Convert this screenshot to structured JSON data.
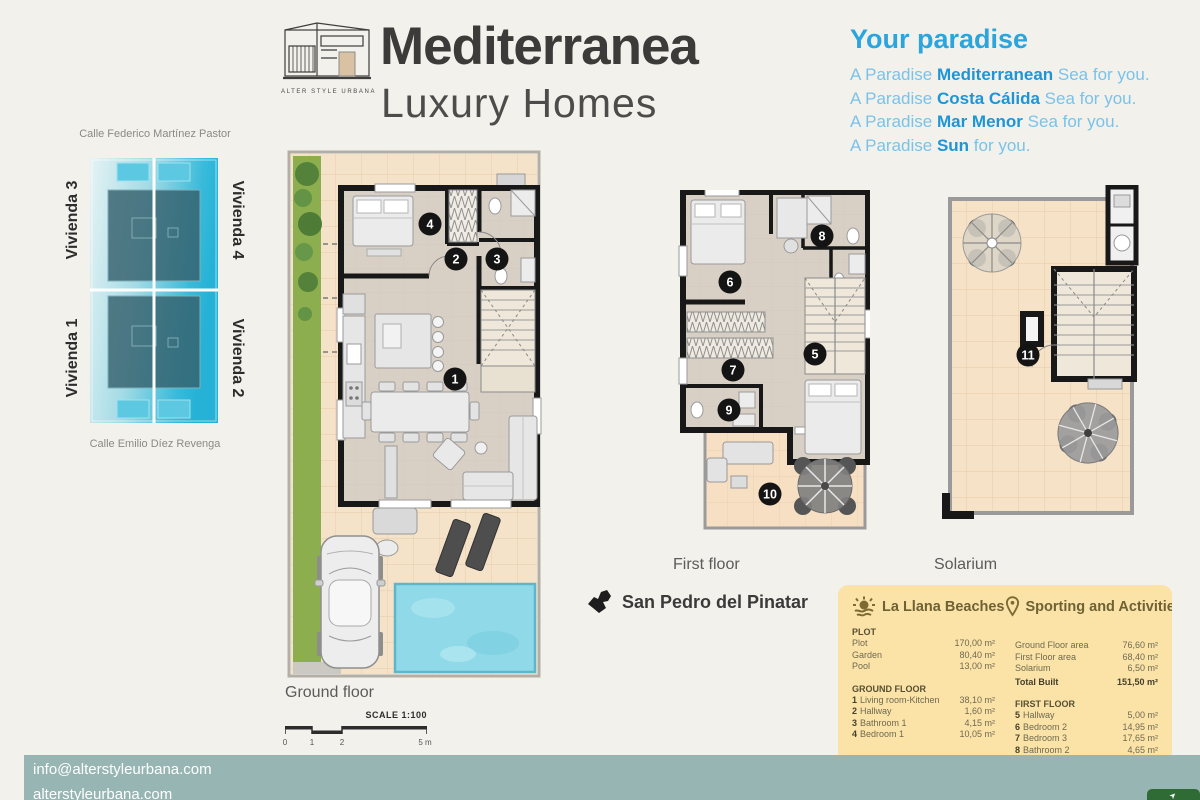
{
  "brand": {
    "caption": "ALTER STYLE URBANA",
    "title": "Mediterranea",
    "subtitle": "Luxury Homes"
  },
  "paradise": {
    "title": "Your paradise",
    "lines": [
      {
        "pre": "A Paradise ",
        "em": "Mediterranean",
        "post": " Sea for you."
      },
      {
        "pre": "A Paradise ",
        "em": "Costa Cálida",
        "post": " Sea for you."
      },
      {
        "pre": "A Paradise ",
        "em": "Mar Menor",
        "post": " Sea for you."
      },
      {
        "pre": "A Paradise ",
        "em": "Sun",
        "post": " for you."
      }
    ]
  },
  "site": {
    "street_top": "Calle Federico Martínez Pastor",
    "street_bottom": "Calle Emilio Díez Revenga",
    "unit_tl": "Vivienda 3",
    "unit_tr": "Vivienda 4",
    "unit_bl": "Vivienda 1",
    "unit_br": "Vivienda 2"
  },
  "plans": {
    "ground_label": "Ground floor",
    "first_label": "First floor",
    "solarium_label": "Solarium",
    "scale_label": "SCALE 1:100",
    "scale_ticks": [
      "0",
      "1",
      "2",
      "5 m"
    ],
    "markers": {
      "m1": "1",
      "m2": "2",
      "m3": "3",
      "m4": "4",
      "m5": "5",
      "m6": "6",
      "m7": "7",
      "m8": "8",
      "m9": "9",
      "m10": "10",
      "m11": "11"
    }
  },
  "location": {
    "name": "San Pedro del Pinatar"
  },
  "panel": {
    "beaches_title": "La Llana Beaches",
    "sports_title": "Sporting and Activities",
    "plot": {
      "title": "PLOT",
      "rows": [
        {
          "l": "Plot",
          "v": "170,00 m²"
        },
        {
          "l": "Garden",
          "v": "80,40 m²"
        },
        {
          "l": "Pool",
          "v": "13,00 m²"
        }
      ]
    },
    "built": {
      "rows": [
        {
          "l": "Ground Floor area",
          "v": "76,60 m²"
        },
        {
          "l": "First Floor area",
          "v": "68,40 m²"
        },
        {
          "l": "Solarium",
          "v": "6,50 m²"
        }
      ],
      "total_l": "Total Built",
      "total_v": "151,50 m²"
    },
    "ground": {
      "title": "GROUND FLOOR",
      "rows": [
        {
          "n": "1",
          "l": "Living room-Kitchen",
          "v": "38,10 m²"
        },
        {
          "n": "2",
          "l": "Hallway",
          "v": "1,60 m²"
        },
        {
          "n": "3",
          "l": "Bathroom 1",
          "v": "4,15 m²"
        },
        {
          "n": "4",
          "l": "Bedroom 1",
          "v": "10,05 m²"
        }
      ],
      "total_l": "Total floor area",
      "total_v": "76,60 m²"
    },
    "first": {
      "title": "FIRST FLOOR",
      "rows": [
        {
          "n": "5",
          "l": "Hallway",
          "v": "5,00 m²"
        },
        {
          "n": "6",
          "l": "Bedroom 2",
          "v": "14,95 m²"
        },
        {
          "n": "7",
          "l": "Bedroom 3",
          "v": "17,65 m²"
        },
        {
          "n": "8",
          "l": "Bathroom 2",
          "v": "4,65 m²"
        },
        {
          "n": "9",
          "l": "Bathroom 3",
          "v": "4,75 m²"
        },
        {
          "n": "10",
          "l": "Terrace",
          "v": "14,40 m²"
        }
      ],
      "total_l": "Total floor area",
      "total_v": "47,00 m²"
    },
    "solarium_title": "SOLARIUM"
  },
  "footer": {
    "email": "info@alterstyleurbana.com",
    "website": "alterstyleurbana.com"
  },
  "colors": {
    "accent_blue": "#2aa5de",
    "panel_yellow": "#fbe3a8",
    "footer_teal": "#97b5b2",
    "pool_cyan": "#8fd9e8",
    "site_cyan": "#35b9d9",
    "button_green": "#2e6b35"
  }
}
